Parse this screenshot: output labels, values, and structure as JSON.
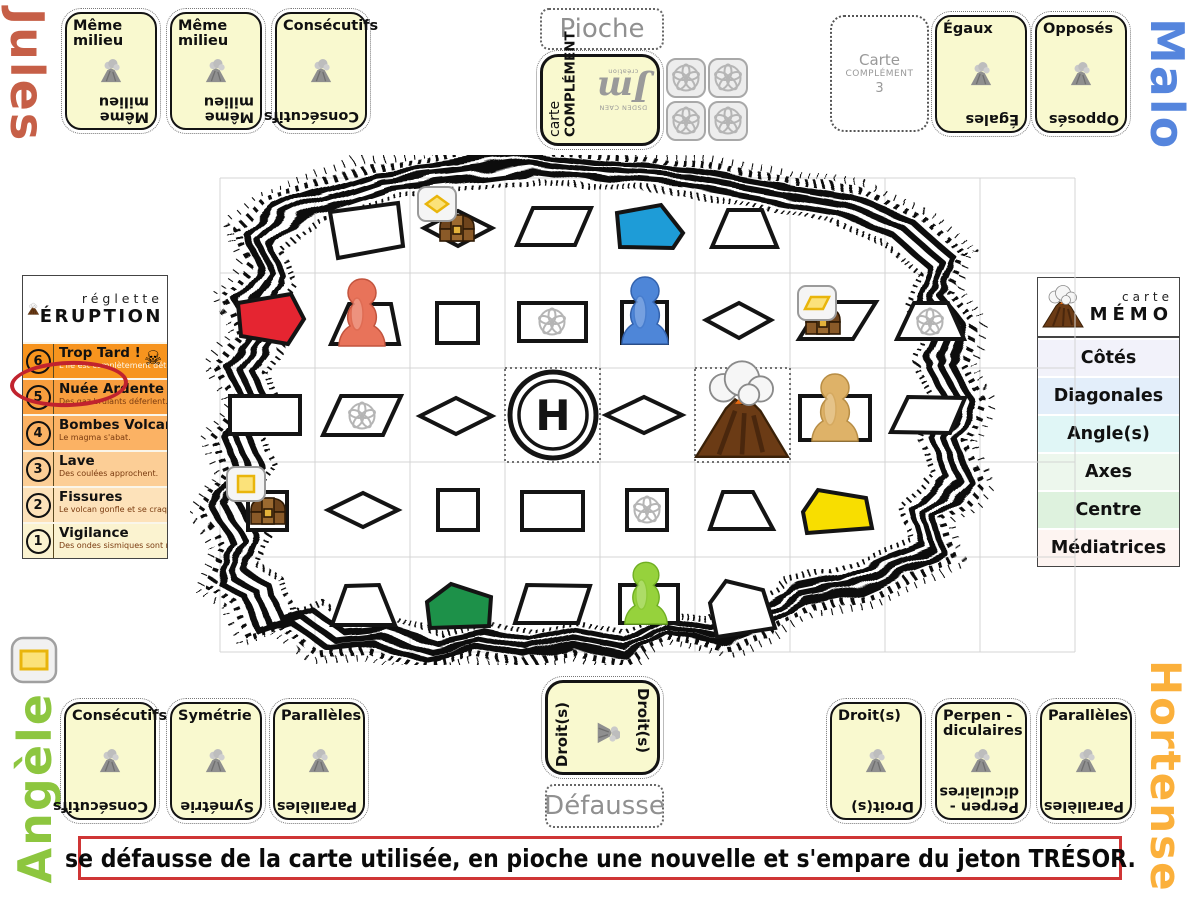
{
  "players": {
    "jules": {
      "name": "Jules",
      "color": "#c65f47",
      "cards": [
        {
          "top": "Même milieu",
          "bottom": "Même milieu"
        },
        {
          "top": "Même milieu",
          "bottom": "Même milieu"
        },
        {
          "top": "Consécutifs",
          "bottom": "Consécutifs"
        }
      ]
    },
    "malo": {
      "name": "Malo",
      "color": "#5585dd",
      "cards": [
        {
          "top": "Égaux",
          "bottom": "Égales"
        },
        {
          "top": "Opposés",
          "bottom": "Opposés"
        }
      ]
    },
    "angele": {
      "name": "Angèle",
      "color": "#8dc63f",
      "cards": [
        {
          "top": "Consécutifs",
          "bottom": "Consécutifs"
        },
        {
          "top": "Symétrie",
          "bottom": "Symétrie"
        },
        {
          "top": "Parallèles",
          "bottom": "Parallèles"
        }
      ]
    },
    "hortense": {
      "name": "Hortense",
      "color": "#fbb03b",
      "cards": [
        {
          "top": "Droit(s)",
          "bottom": "Droit(s)"
        },
        {
          "top": "Perpen -diculaires",
          "bottom": "Perpen -diculaires"
        },
        {
          "top": "Parallèles",
          "bottom": "Parallèles"
        }
      ]
    }
  },
  "piles": {
    "draw_label": "Pioche",
    "discard_label": "Défausse",
    "draw_card": {
      "line1": "carte",
      "line2": "COMPLÉMENT",
      "logo_top": "DSDEN CAEN",
      "logo_main": "Jm",
      "logo_sub": "création"
    },
    "discard_card": {
      "label": "Droit(s)"
    },
    "complement_slot": {
      "line1": "Carte",
      "line2": "COMPLÉMENT",
      "line3": "3"
    }
  },
  "reglette": {
    "title_small": "réglette",
    "title_big": "ÉRUPTION",
    "skull_icon": "☠",
    "rows": [
      {
        "num": "6",
        "title": "Trop Tard !",
        "subtitle": "L'île est complètement détruite.",
        "color": "#f7941e",
        "skull": true
      },
      {
        "num": "5",
        "title": "Nuée Ardente",
        "subtitle": "Des gaz brûlants déferlent.",
        "color": "#f89e3e",
        "circled": true
      },
      {
        "num": "4",
        "title": "Bombes Volcaniques",
        "subtitle": "Le magma s'abat.",
        "color": "#fbb264"
      },
      {
        "num": "3",
        "title": "Lave",
        "subtitle": "Des coulées approchent.",
        "color": "#fcce96"
      },
      {
        "num": "2",
        "title": "Fissures",
        "subtitle": "Le volcan gonfle et se craquelle.",
        "color": "#fde2ba"
      },
      {
        "num": "1",
        "title": "Vigilance",
        "subtitle": "Des ondes sismiques sont ressenties.",
        "color": "#fbf3d0"
      }
    ]
  },
  "memo": {
    "title_small": "carte",
    "title_big": "MÉMO",
    "rows": [
      {
        "label": "Côtés",
        "color": "#f2f2fa"
      },
      {
        "label": "Diagonales",
        "color": "#e3eefa"
      },
      {
        "label": "Angle(s)",
        "color": "#e0f6f6"
      },
      {
        "label": "Axes",
        "color": "#edf7ed"
      },
      {
        "label": "Centre",
        "color": "#def2de"
      },
      {
        "label": "Médiatrices",
        "color": "#fdf4f1"
      }
    ]
  },
  "banner": {
    "text": "se défausse de la carte utilisée, en pioche une nouvelle et s'empare du jeton TRÉSOR.",
    "border_color": "#cf3535"
  },
  "board": {
    "helipad_letter": "H",
    "pawns": [
      {
        "color_name": "orange",
        "hex": "#e8735a"
      },
      {
        "color_name": "blue",
        "hex": "#4e86d8"
      },
      {
        "color_name": "tan",
        "hex": "#deb268"
      },
      {
        "color_name": "green",
        "hex": "#96d23c"
      }
    ],
    "colored_shapes": [
      {
        "shape": "quadrilateral",
        "hex": "#1e9cd7"
      },
      {
        "shape": "quadrilateral",
        "hex": "#e52531"
      },
      {
        "shape": "quadrilateral",
        "hex": "#f8de00"
      },
      {
        "shape": "quadrilateral",
        "hex": "#1d9149"
      }
    ],
    "treasure_chest_count": 3,
    "objective_token_glyphs": [
      "diamond",
      "parallelogram",
      "square",
      "rectangle"
    ],
    "draw_token_count": 4
  }
}
